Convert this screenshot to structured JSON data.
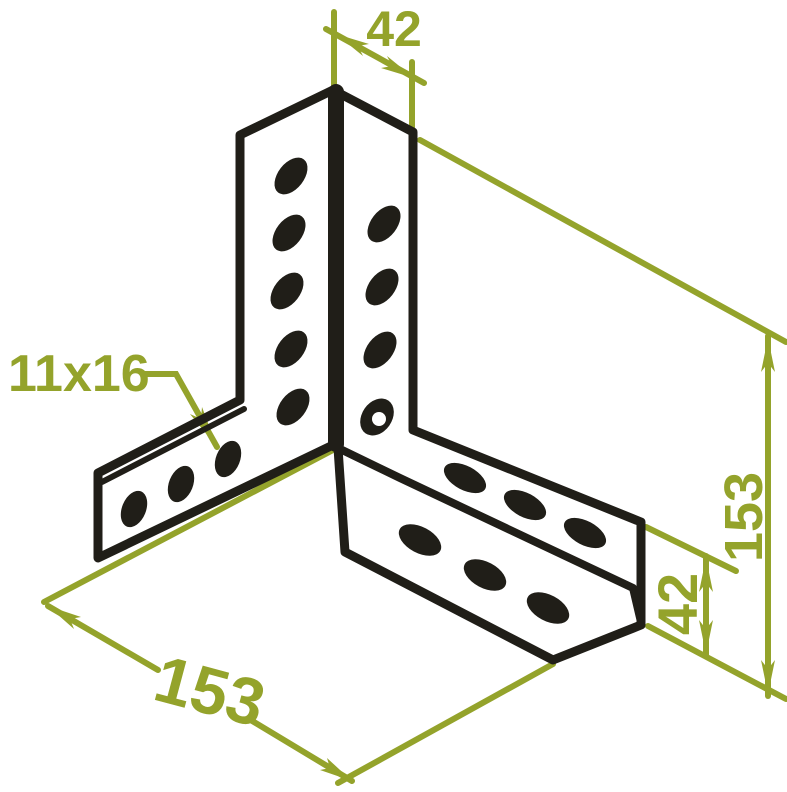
{
  "page": {
    "width": 787,
    "height": 792,
    "background": "#ffffff"
  },
  "diagram": {
    "description": "Isometric technical line drawing of a corner angle bracket with slotted holes",
    "stroke_color": "#201e18",
    "dimension_color": "#94a32b",
    "labels": {
      "top_width": "42",
      "slot_size": "11x16",
      "bottom_length": "153",
      "right_height": "153",
      "right_leg_width": "42"
    },
    "slots": {
      "upright_left_face": 5,
      "upright_right_face": 4,
      "left_leg_face": 3,
      "right_leg_top_face": 3,
      "right_leg_front_face": 3
    }
  }
}
